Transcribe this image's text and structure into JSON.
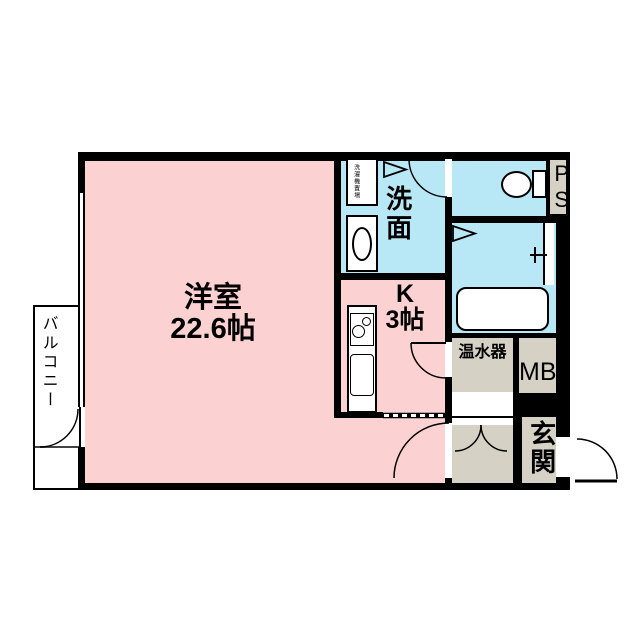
{
  "plan_title": "1R floor plan",
  "rooms": {
    "living": {
      "name": "洋室",
      "size": "22.6帖"
    },
    "kitchen": {
      "name": "K",
      "size": "3帖"
    },
    "washroom": {
      "name": "洗面"
    },
    "laundry": {
      "name": "洗濯機置場"
    },
    "water_heater": {
      "name": "温水器"
    },
    "meter_box": {
      "name": "MB"
    },
    "pipe_space": {
      "name": "PS"
    },
    "entrance": {
      "name": "玄関"
    },
    "balcony": {
      "name": "バルコニー"
    }
  },
  "colors": {
    "room_pink": "#fcd1d1",
    "wet_cyan": "#b8e8f5",
    "hall_tan": "#d5d1c4",
    "wall": "#000000"
  }
}
